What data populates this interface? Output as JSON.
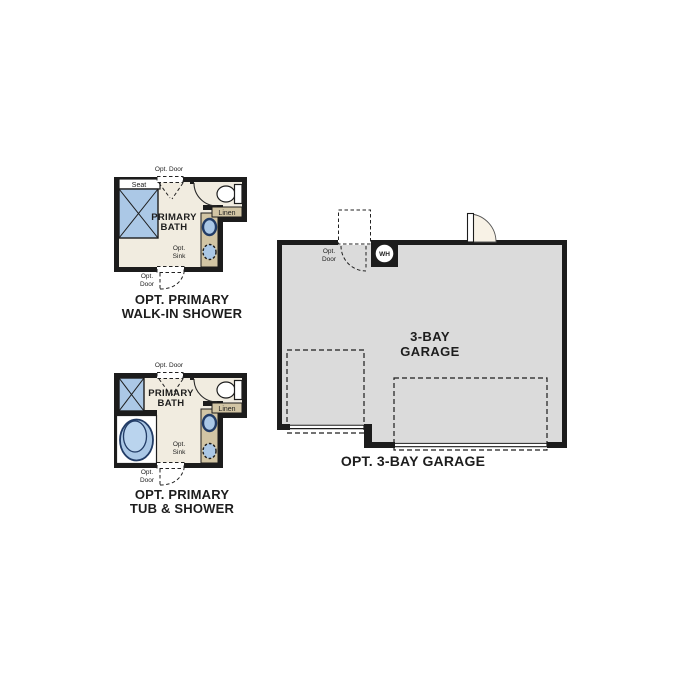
{
  "colors": {
    "wall": "#1c1c1c",
    "bath_floor": "#f1ece0",
    "vanity_tan": "#d2c5a4",
    "fixture_blue": "#abc8e6",
    "fixture_blue_light": "#bad4ee",
    "fixture_ring": "#223c66",
    "garage_floor": "#dbdbdb",
    "door_cream": "#f8f2e6",
    "white": "#ffffff"
  },
  "bath_walkin": {
    "caption_line1": "OPT. PRIMARY",
    "caption_line2": "WALK-IN SHOWER",
    "opt_door_top": "Opt. Door",
    "seat": "Seat",
    "room_line1": "PRIMARY",
    "room_line2": "BATH",
    "linen": "Linen",
    "opt_sink_line1": "Opt.",
    "opt_sink_line2": "Sink",
    "opt_door_bottom_line1": "Opt.",
    "opt_door_bottom_line2": "Door"
  },
  "bath_tub": {
    "caption_line1": "OPT. PRIMARY",
    "caption_line2": "TUB & SHOWER",
    "opt_door_top": "Opt. Door",
    "room_line1": "PRIMARY",
    "room_line2": "BATH",
    "linen": "Linen",
    "opt_sink_line1": "Opt.",
    "opt_sink_line2": "Sink",
    "opt_door_bottom_line1": "Opt.",
    "opt_door_bottom_line2": "Door"
  },
  "garage": {
    "caption": "OPT. 3-BAY GARAGE",
    "opt_door_line1": "Opt.",
    "opt_door_line2": "Door",
    "water_heater": "WH",
    "room_line1": "3-BAY",
    "room_line2": "GARAGE"
  }
}
